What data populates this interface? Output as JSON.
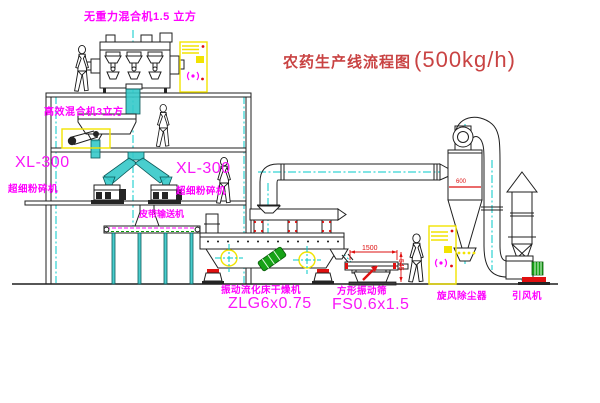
{
  "title": {
    "text": "农药生产线流程图",
    "capacity": "(500kg/h)"
  },
  "labels": {
    "top_mixer": "无重力混合机1.5 立方",
    "floor2_mixer": "高效混合机3立方",
    "mill_left_model": "XL-300",
    "mill_left_name": "超细粉碎机",
    "mill_right_model": "XL-300",
    "mill_right_name": "超细粉碎机",
    "belt_conveyor": "皮带输送机",
    "dryer_name": "振动流化床干燥机",
    "dryer_model": "ZLG6x0.75",
    "screen_name": "方形振动筛",
    "screen_model": "FS0.6x1.5",
    "cyclone": "旋风除尘器",
    "fan": "引风机"
  },
  "dimensions": {
    "screen_length": "1500",
    "screen_height": "545",
    "cyclone_diameter": "600"
  },
  "colors": {
    "line": "#1f1f1f",
    "centerline_cyan": "#00c9c9",
    "label_magenta": "#ff00ff",
    "title_red": "#c94343",
    "accent_red": "#dd1010",
    "cabinet_yellow": "#f2e300",
    "motor_green": "#16a216"
  }
}
